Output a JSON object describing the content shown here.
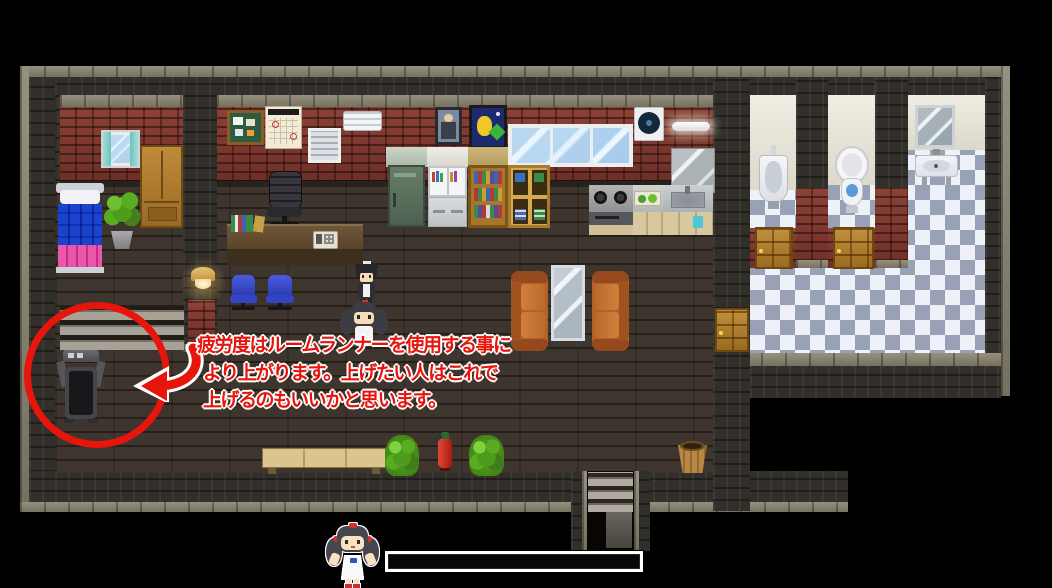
{
  "scene": {
    "annotation": {
      "line1": "疲労度はルームランナーを使用する事に",
      "line2": "より上がります。上げたい人はこれで",
      "line3": "上げるのもいいかと思います。",
      "text_color": "#e8150d",
      "outline_color": "#ffffff"
    },
    "hud": {
      "gauge_value": "",
      "gauge_border_color": "#ffffff",
      "gauge_fill_color": "#070707"
    },
    "palette": {
      "background": "#000000",
      "floor_wood": "#3a332c",
      "wall_red_brick": "#7d362f",
      "wall_dark": "#2c2925",
      "wall_stone_cap": "#87816f",
      "tile_light": "#eef1f7",
      "tile_dark": "#98a1b6",
      "annotation_red": "#e8150d",
      "couch_orange": "#bc6a2e",
      "door_wood": "#b5822e"
    }
  }
}
